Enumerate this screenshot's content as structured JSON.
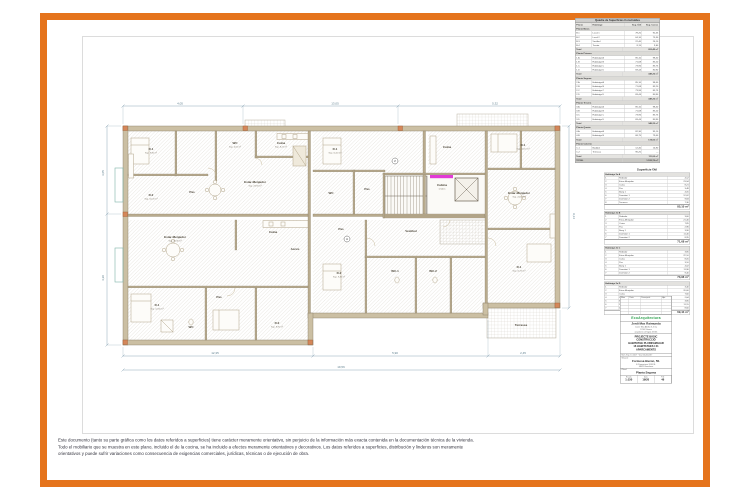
{
  "sheet": {
    "disclaimer_lines": [
      "Este documento (tanto su parte gráfica como los datos referidos a superficies) tiene carácter meramente orientativo, sin perjuicio de la información más exacta contenida en la documentación técnica de la vivienda.",
      "Todo el mobiliario que se muestra en este plano, incluido el de la cocina, se ha incluido a efectos meramente orientativos y decorativos. Los datos referidos a superficies, distribución y linderos son meramente",
      "orientativos y puede sufrir variaciones como consecuencia de exigencias comerciales, jurídicas, técnicas o de ejecución de obra."
    ]
  },
  "plan": {
    "colors": {
      "wall": "#cbbfa3",
      "wall_stroke": "#857a63",
      "accent_magenta": "#e23ad6",
      "pillar": "#d4875a",
      "dim": "#8fa8b8",
      "hatch": "#dedad2"
    },
    "rooms": [
      {
        "t": "D.1",
        "s": "Sup. 9,80 m²",
        "x": 56,
        "y": 52
      },
      {
        "t": "D.2",
        "s": "Sup. 10,20 m²",
        "x": 56,
        "y": 98
      },
      {
        "t": "Pas",
        "s": "",
        "x": 97,
        "y": 95
      },
      {
        "t": "WC",
        "s": "Sup. 4,05 m²",
        "x": 140,
        "y": 46
      },
      {
        "t": "Cuina",
        "s": "Sup. 8,21 m²",
        "x": 186,
        "y": 46
      },
      {
        "t": "Estar-Menjador",
        "s": "Sup. 23,94 m²",
        "x": 160,
        "y": 85
      },
      {
        "t": "Estar-Menjador",
        "s": "Sup. 26,30 m²",
        "x": 80,
        "y": 140
      },
      {
        "t": "Cuina",
        "s": "",
        "x": 178,
        "y": 135
      },
      {
        "t": "Accés",
        "s": "",
        "x": 200,
        "y": 152
      },
      {
        "t": "D.1",
        "s": "Sup. 12,60 m²",
        "x": 62,
        "y": 208
      },
      {
        "t": "Pas",
        "s": "",
        "x": 124,
        "y": 200
      },
      {
        "t": "WC",
        "s": "",
        "x": 96,
        "y": 230
      },
      {
        "t": "D.2",
        "s": "Sup. 8,90 m²",
        "x": 182,
        "y": 226
      },
      {
        "t": "D.1",
        "s": "Sup. 11,40 m²",
        "x": 240,
        "y": 52
      },
      {
        "t": "WC",
        "s": "",
        "x": 236,
        "y": 96
      },
      {
        "t": "Pas",
        "s": "",
        "x": 272,
        "y": 92
      },
      {
        "t": "Cuina",
        "s": "",
        "x": 352,
        "y": 50
      },
      {
        "t": "D.1",
        "s": "Sup. 10,10 m²",
        "x": 428,
        "y": 48
      },
      {
        "t": "Estar-Menjador",
        "s": "Sup. 24,10 m²",
        "x": 424,
        "y": 96
      },
      {
        "t": "Cabina",
        "s": "s/rodes",
        "x": 347,
        "y": 88
      },
      {
        "t": "Vestíbul",
        "s": "",
        "x": 316,
        "y": 134
      },
      {
        "t": "Pas",
        "s": "",
        "x": 246,
        "y": 132
      },
      {
        "t": "D.2",
        "s": "Sup. 9,40 m²",
        "x": 244,
        "y": 176
      },
      {
        "t": "WC.1",
        "s": "",
        "x": 300,
        "y": 174
      },
      {
        "t": "WC.2",
        "s": "",
        "x": 338,
        "y": 174
      },
      {
        "t": "D.1",
        "s": "Sup. 11,90 m²",
        "x": 424,
        "y": 170
      },
      {
        "t": "Terrassa",
        "s": "",
        "x": 426,
        "y": 228
      }
    ],
    "dims": [
      {
        "t": "4,05",
        "x": 85,
        "y": 6.5
      },
      {
        "t": "13,05",
        "x": 240,
        "y": 6.5
      },
      {
        "t": "5,32",
        "x": 400,
        "y": 6.5
      },
      {
        "t": "3,05",
        "x": 9,
        "y": 75,
        "r": -90
      },
      {
        "t": "4,20",
        "x": 9,
        "y": 180,
        "r": -90
      },
      {
        "t": "12,35",
        "x": 120,
        "y": 256
      },
      {
        "t": "5,90",
        "x": 300,
        "y": 256
      },
      {
        "t": "2,45",
        "x": 428,
        "y": 256
      },
      {
        "t": "19,56",
        "x": 246,
        "y": 270
      },
      {
        "t": "9,14",
        "x": 478,
        "y": 118,
        "r": 90
      }
    ],
    "markers": [
      {
        "t": "A",
        "x": 252,
        "y": 141
      },
      {
        "t": "2",
        "x": 300,
        "y": 63
      }
    ]
  },
  "built_table": {
    "title": "Quadre de Superfícies Construïdes",
    "columns": [
      "Planta",
      "Habitatge",
      "Sup. Útil",
      "Sup. Const."
    ],
    "sections": [
      {
        "label": "Planta Baixa",
        "rows": [
          [
            "B.1",
            "Local 1",
            "78,20",
            "92,45"
          ],
          [
            "B.2",
            "Local 2",
            "64,10",
            "75,30"
          ],
          [
            "B.3",
            "Vestíbul",
            "22,40",
            "26,10"
          ],
          [
            "B.4",
            "Traster",
            "8,15",
            "9,60"
          ]
        ],
        "total": "203,45 m²"
      },
      {
        "label": "Planta Primera",
        "rows": [
          [
            "1.A",
            "Habitatge A",
            "85,10",
            "98,40"
          ],
          [
            "1.B",
            "Habitatge B",
            "71,68",
            "83,20"
          ],
          [
            "1.C",
            "Habitatge C",
            "73,96",
            "85,75"
          ],
          [
            "1.D",
            "Habitatge D",
            "69,44",
            "80,90"
          ]
        ],
        "total": "348,25 m²"
      },
      {
        "label": "Planta Segona",
        "rows": [
          [
            "2.A",
            "Habitatge A",
            "85,10",
            "98,40"
          ],
          [
            "2.B",
            "Habitatge B",
            "71,68",
            "83,20"
          ],
          [
            "2.C",
            "Habitatge C",
            "73,96",
            "85,75"
          ],
          [
            "2.D",
            "Habitatge D",
            "69,44",
            "80,90"
          ]
        ],
        "total": "348,25 m²"
      },
      {
        "label": "Planta Tercera",
        "rows": [
          [
            "3.A",
            "Habitatge A",
            "85,10",
            "98,40"
          ],
          [
            "3.B",
            "Habitatge B",
            "71,68",
            "83,20"
          ],
          [
            "3.C",
            "Habitatge C",
            "73,96",
            "85,75"
          ],
          [
            "3.D",
            "Habitatge D",
            "69,44",
            "80,90"
          ]
        ],
        "total": "348,25 m²"
      },
      {
        "label": "Planta Quarta",
        "rows": [
          [
            "4.A",
            "Habitatge A",
            "82,30",
            "95,10"
          ],
          [
            "4.B",
            "Habitatge B",
            "68,75",
            "79,40"
          ]
        ],
        "total": "174,50 m²"
      },
      {
        "label": "Planta Coberta",
        "rows": [
          [
            "C.1",
            "Badalot",
            "12,40",
            "14,80"
          ],
          [
            "C.2",
            "Terrassa",
            "96,20",
            "—"
          ]
        ],
        "total": "111,00 m²"
      }
    ],
    "grand_total_label": "TOTAL",
    "grand_total": "1.533,70 m²"
  },
  "useful_table": {
    "title": "Superfície Útil",
    "sections": [
      {
        "label": "Habitatge 2n A",
        "rows": [
          [
            "1",
            "Rebedor",
            "4,12"
          ],
          [
            "2",
            "Estar-Menjador",
            "23,94"
          ],
          [
            "3",
            "Cuina",
            "8,21"
          ],
          [
            "4",
            "Pas",
            "3,48"
          ],
          [
            "5",
            "Bany 1",
            "4,05"
          ],
          [
            "6",
            "Dormitori 1",
            "12,62"
          ],
          [
            "7",
            "Dormitori 2",
            "9,84"
          ],
          [
            "8",
            "Terrassa",
            "7,30"
          ]
        ],
        "total": "85,10 m²"
      },
      {
        "label": "Habitatge 2n B",
        "rows": [
          [
            "1",
            "Rebedor",
            "3,60"
          ],
          [
            "2",
            "Estar-Menjador",
            "21,40"
          ],
          [
            "3",
            "Cuina",
            "7,85"
          ],
          [
            "4",
            "Pas",
            "2,96"
          ],
          [
            "5",
            "Bany 1",
            "3,90"
          ],
          [
            "6",
            "Dormitori 1",
            "11,40"
          ],
          [
            "7",
            "Dormitori 2",
            "8,95"
          ]
        ],
        "total": "71,68 m²"
      },
      {
        "label": "Habitatge 2n C",
        "rows": [
          [
            "1",
            "Rebedor",
            "3,85"
          ],
          [
            "2",
            "Estar-Menjador",
            "22,10"
          ],
          [
            "3",
            "Cuina",
            "8,05"
          ],
          [
            "4",
            "Pas",
            "3,10"
          ],
          [
            "5",
            "Bany 1",
            "4,02"
          ],
          [
            "6",
            "Dormitori 1",
            "11,90"
          ],
          [
            "7",
            "Dormitori 2",
            "9,40"
          ]
        ],
        "total": "73,96 m²"
      },
      {
        "label": "Habitatge 2n D",
        "rows": [
          [
            "1",
            "Rebedor",
            "3,40"
          ],
          [
            "2",
            "Estar-Menjador",
            "20,60"
          ],
          [
            "3",
            "Cuina",
            "7,60"
          ],
          [
            "4",
            "Pas",
            "2,84"
          ],
          [
            "5",
            "Bany 1",
            "3,85"
          ],
          [
            "6",
            "Dormitori 1",
            "11,15"
          ],
          [
            "7",
            "Dormitori 2",
            "8,60"
          ]
        ],
        "total": "69,44 m²"
      }
    ]
  },
  "titleblock": {
    "revisions": {
      "columns": [
        "Núm",
        "Data",
        "Descripció",
        "Apr."
      ],
      "empty_rows": 5
    },
    "logo": "EcoArquitectura",
    "architect": "Jordi Mas Raimunda",
    "architect_lines": [
      "Carrer Mas Abella 8, 4t 1a",
      "17002 Girona",
      "arquitecte col·legiat 43.341"
    ],
    "project_lines": [
      "PROJECTE BÀSIC",
      "CONSTRUCCIÓ",
      "HABITATGE PLURIFAMILIAR",
      "16 HABITATGES I 21",
      "APARCAMENTS"
    ],
    "expedient": "Núm. Exp. 17-2017 · Visat 20-08-2017",
    "situacio_label": "Situació:",
    "situacio": "Formosa Hieron, 50.",
    "promotor_lines": [
      "E.Promocions 2016 SL",
      "08021 Barcelona"
    ],
    "planol_label": "Plànol:",
    "planol": "Planta Segona",
    "scale_label": "Escala",
    "scale_value": "1:150",
    "date_label": "Data",
    "date_value": "19/20",
    "sheet_label": "Full",
    "sheet_value": "46"
  }
}
